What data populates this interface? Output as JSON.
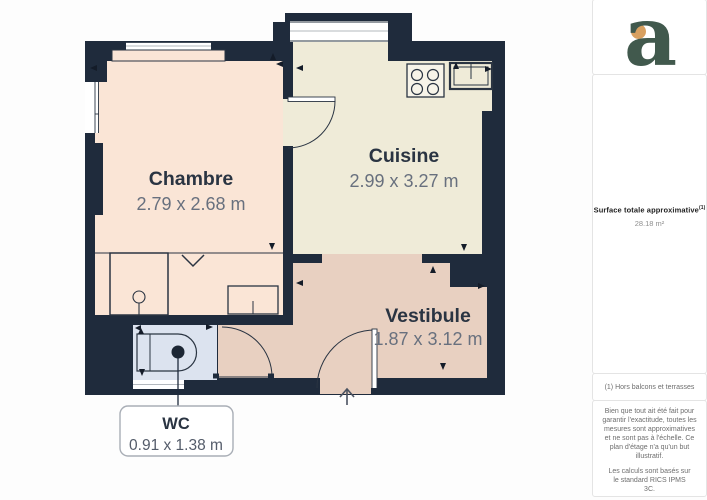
{
  "canvas": {
    "width": 707,
    "height": 500,
    "background": "#FDFDFD"
  },
  "colors": {
    "wall": "#1F2B3C",
    "line": "#2A3442",
    "chambre": "#FAE5D6",
    "cuisine": "#EFEBD8",
    "vestibule": "#E8D0C1",
    "wc": "#DCE3EF",
    "dim_text": "#68707E",
    "logo_green": "#41594D",
    "logo_orange": "#D8A060",
    "callout_border": "#A9AEB6"
  },
  "rooms": [
    {
      "id": "chambre",
      "name": "Chambre",
      "dimensions": "2.79 x 2.68 m"
    },
    {
      "id": "cuisine",
      "name": "Cuisine",
      "dimensions": "2.99 x 3.27 m"
    },
    {
      "id": "vestibule",
      "name": "Vestibule",
      "dimensions": "1.87 x 3.12 m"
    },
    {
      "id": "wc",
      "name": "WC",
      "dimensions": "0.91 x 1.38 m"
    }
  ],
  "fixtures": [
    "stove",
    "sink",
    "shower",
    "washbasin",
    "toilet",
    "entry-door",
    "interior-door",
    "wc-door",
    "windows"
  ],
  "sidebar": {
    "logo_letter": "a",
    "surface_label": "Surface totale approximative",
    "surface_sup": "(1)",
    "surface_value": "28.18 m²",
    "footnote": "(1) Hors balcons et terrasses",
    "disclaimer": "Bien que tout ait été fait pour garantir l'exactitude, toutes les mesures sont approximatives et ne sont pas à l'échelle. Ce plan d'étage n'a qu'un but illustratif.",
    "standard": "Les calculs sont basés sur le standard RICS IPMS 3C.",
    "brand": "GIRAFFE",
    "brand_suffix": "360"
  }
}
